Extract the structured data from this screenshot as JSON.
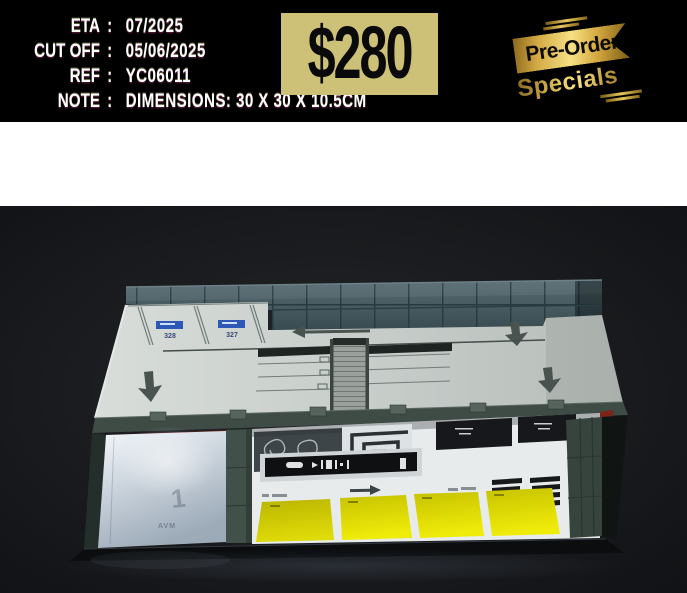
{
  "header": {
    "fields": [
      {
        "label": "ETA",
        "sep": ":",
        "value": "07/2025"
      },
      {
        "label": "CUT OFF",
        "sep": ":",
        "value": "05/06/2025"
      },
      {
        "label": "REF",
        "sep": ":",
        "value": "YC06011"
      },
      {
        "label": "NOTE",
        "sep": ":",
        "value": "DIMENSIONS: 30 X 30 X 10.5CM"
      }
    ],
    "price": "$280",
    "ribbon": {
      "title": "Pre-Order",
      "subtitle": "Specials"
    }
  },
  "photo": {
    "alt": "Model-kit diorama of a two-level parking garage: rooftop parking deck with teal glass wall, illuminated interior level with yellow parking bays, on a dark backdrop",
    "deck_sign_1": "328",
    "deck_sign_2": "327",
    "level_marking": "1",
    "wall_text": "AVM",
    "colors": {
      "price_badge_bg": "#cdc178",
      "ribbon_gold": "#e9ca62",
      "photo_background": "#1a1c1f",
      "deck_gray": "#c9cfcc",
      "glass_teal": "#465b61",
      "pillar_green": "#3f4e46",
      "bay_yellow": "#e6e206",
      "interior_white": "#e7ebec",
      "accent_red": "#7c231a",
      "sign_blue": "#2e58b8",
      "base_black": "#0b0d0f"
    }
  }
}
